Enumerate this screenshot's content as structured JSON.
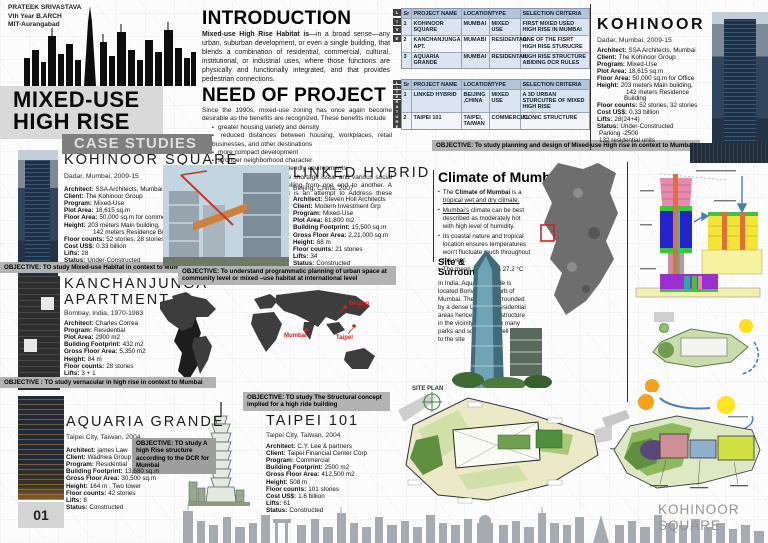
{
  "colors": {
    "accent_gray": "#b3b3b3",
    "header_gray": "#7f7f7f",
    "table_header_blue": "#b4c5da",
    "table_row_blue": "#dbe5f1",
    "map_marker_red": "#cc2222"
  },
  "header": {
    "author_line1": "PRATEEK SRIVASTAVA",
    "author_line2": "Vth Year B.ARCH",
    "author_line3": "MIT-Aurangabad",
    "title_line1": "MIXED-USE",
    "title_line2": "HIGH RISE",
    "case_studies": "CASE STUDIES"
  },
  "intro": {
    "heading": "INTRODUCTION",
    "lead_bold": "Mixed-use High Rise Habitat is",
    "lead_rest": "—in a broad sense—any urban, suburban development, or even a single building, that blends a combination of residential, commercial, cultural, institutional, or industrial uses, where those functions are physically and functionally integrated, and that provides pedestrian connections."
  },
  "need": {
    "heading": "NEED OF PROJECT",
    "para1": "Since the 1990s, mixed-use zoning has once again become desirable as the benefits are recognized. These benefits include",
    "bullets": [
      "greater housing variety and density",
      "reduced distances between housing, workplaces, retail businesses, and other destinations",
      "more compact development",
      "stronger neighborhood character",
      "pedestrian and bicycle-friendly environments"
    ],
    "para2": "Mumbai currently faces Space shortage issue and various social issues one of which is travelling from one end to another. A resilient mixed-used complex is an attempt to Address these issues."
  },
  "tables": {
    "headers": [
      "Sr",
      "PROJECT NAME",
      "LOCATION",
      "TYPE",
      "SELECTION CRITERIA"
    ],
    "live_label": [
      "L",
      "I",
      "V",
      "E"
    ],
    "literature_label": [
      "L",
      "I",
      "T",
      "E",
      "R",
      "A",
      "T",
      "U",
      "R",
      "E"
    ],
    "live_rows": [
      [
        "1",
        "KOHINOOR SQUARE",
        "MUMBAI",
        "MIXED USE",
        "FIRST MIXED USED HIGH RISE IN MUMBAI"
      ],
      [
        "2",
        "KANCHANJUNGA APT.",
        "MUMABI",
        "RESIDENTAIL",
        "ONE OF THE FISRT HIGH RISE STURUCRE"
      ],
      [
        "3",
        "AQUARIA GRANDE",
        "MUMBAI",
        "RESIDENTAIL",
        "HIGH RISE STRUCTURE ABIDING DCR RULES"
      ]
    ],
    "literature_rows": [
      [
        "1",
        "LINKED HYBRID",
        "BEIJING ,CHINA",
        "MIXED USE",
        "A 3D URBAN STURCUTRE OF MIXED HIGH RISE"
      ],
      [
        "2",
        "TAIPEI 101",
        "TAIPEI, TAIWAN",
        "COMMERCIAL",
        "ICONIC STRUCTURE"
      ]
    ],
    "objective": "OBJECTIVE: To study planning and design of Mixed-use High rise in context to Mumbai"
  },
  "kohinoor_left": {
    "title": "KOHINOOR SQUARE",
    "location": "Dadar, Mumbai, 2009-15",
    "details": [
      {
        "label": "Architect:",
        "value": "SSA Architects, Mumbai"
      },
      {
        "label": "Client:",
        "value": "The Kohinoor Group"
      },
      {
        "label": "Program:",
        "value": "Mixed-Use"
      },
      {
        "label": "Plot Area:",
        "value": "18,615 sq.m"
      },
      {
        "label": "Floor Area:",
        "value": "50,000 sq.m for commercial"
      },
      {
        "label": "Height:",
        "value": "203 meters Main building,"
      },
      {
        "label": "",
        "value": "142 meters Residence Building",
        "indent": "1"
      },
      {
        "label": "Floor counts:",
        "value": "52 stories, 28 stories"
      },
      {
        "label": "Cost US$:",
        "value": "0.33 billion"
      },
      {
        "label": "Lifts:",
        "value": "28"
      },
      {
        "label": "Status:",
        "value": "Under-Constructed"
      }
    ],
    "objective": "OBJECTIVE: TO study Mixed-use Habitat in context to Mumbai"
  },
  "kanchanjunga": {
    "title_line1": "KANCHANJUNGA",
    "title_line2": "APARTMENT",
    "location": "Bombay, India, 1970-1983",
    "details": [
      {
        "label": "Architect:",
        "value": "Charles Correa"
      },
      {
        "label": "Program:",
        "value": "Residential"
      },
      {
        "label": "Plot Area:",
        "value": "2900 m2"
      },
      {
        "label": "Building Footprint:",
        "value": "432 m2"
      },
      {
        "label": "Gross Floor Area:",
        "value": "5,350 m2"
      },
      {
        "label": "Height:",
        "value": "84 m"
      },
      {
        "label": "Floor counts:",
        "value": "28 stories"
      },
      {
        "label": "Lifts:",
        "value": "3 + 1"
      },
      {
        "label": "Status:",
        "value": "Constructed"
      }
    ],
    "objective": "OBJECTIVE : TO study vernacular in high rise in context to Mumbai"
  },
  "aquaria": {
    "title": "AQUARIA GRANDE",
    "location": "Taipei City, Taiwan, 2004",
    "objective": "OBJECTIVE: TO study A high Rise structure according to the DCR for Mumbai",
    "details": [
      {
        "label": "Architect:",
        "value": "james Law"
      },
      {
        "label": "Client:",
        "value": "Wadhwa Group"
      },
      {
        "label": "Program:",
        "value": "Residential"
      },
      {
        "label": "Building Footprint:",
        "value": "13,680 sq.m"
      },
      {
        "label": "Gross Floor Area:",
        "value": "30,500 sq.m"
      },
      {
        "label": "Height:",
        "value": "164 m , Two tower"
      },
      {
        "label": "Floor counts:",
        "value": "42 stories"
      },
      {
        "label": "Lifts:",
        "value": "8"
      },
      {
        "label": "Status:",
        "value": "Constructed"
      }
    ]
  },
  "linked_hybrid": {
    "title": "LINKED HYBRID",
    "location": "Beijing, China, 2007",
    "details": [
      {
        "label": "Architect:",
        "value": "Steven Holl Architects"
      },
      {
        "label": "Client:",
        "value": "Modern Investment Grp"
      },
      {
        "label": "Program:",
        "value": "Mixed-Use"
      },
      {
        "label": "Plot Area:",
        "value": "61,800 m2"
      },
      {
        "label": "Building Footprint:",
        "value": "15,500 sq.m"
      },
      {
        "label": "Gross Floor Area:",
        "value": "2,21,000 sq.m"
      },
      {
        "label": "Height:",
        "value": "68 m"
      },
      {
        "label": "Floor counts:",
        "value": "21 stories"
      },
      {
        "label": "Lifts:",
        "value": "34"
      },
      {
        "label": "Status:",
        "value": "Constructed"
      }
    ],
    "objective": "OBJECTIVE: To understand  programmatic planning of urban space at community level or mixed –use habitat at international level"
  },
  "taipei": {
    "objective": "OBJECTIVE: TO study The Structural concept implied for a high ride building",
    "title": "TAIPEI 101",
    "location": "Taipei City, Taiwan, 2004",
    "details": [
      {
        "label": "Architect:",
        "value": "C.Y. Lee & partners"
      },
      {
        "label": "Client:",
        "value": "Taipei Financial Center Corp"
      },
      {
        "label": "Program:",
        "value": "Commercial"
      },
      {
        "label": "Building Footprint:",
        "value": "2500 m2"
      },
      {
        "label": "Gross Floor Area:",
        "value": "412,500 m2"
      },
      {
        "label": "Height:",
        "value": "508 m"
      },
      {
        "label": "Floor counts:",
        "value": "101 stories"
      },
      {
        "label": "Cost US$:",
        "value": "1.6 billion"
      },
      {
        "label": "Lifts:",
        "value": "61"
      },
      {
        "label": "Status:",
        "value": "Constructed"
      }
    ]
  },
  "kohinoor_right": {
    "title": "KOHINOOR SQUARE",
    "location": "Dadar, Mumbai, 2009-15",
    "details": [
      {
        "label": "Architect:",
        "value": "SSA Architects, Mumbai"
      },
      {
        "label": "Client:",
        "value": "The Kohinoor Group"
      },
      {
        "label": "Program:",
        "value": "Mixed-Use"
      },
      {
        "label": "Plot Area:",
        "value": "18,615 sq.m"
      },
      {
        "label": "Floor Area:",
        "value": "50,000 sq.m for Office"
      },
      {
        "label": "Height:",
        "value": "203 meters Main building,"
      },
      {
        "label": "",
        "value": "142 meters Residence Building",
        "indent": "1"
      },
      {
        "label": "Floor counts:",
        "value": "52 stories, 32 stories"
      },
      {
        "label": "Cost US$:",
        "value": "0.33 billion"
      },
      {
        "label": "Lifts:",
        "value": "28(24+4)"
      },
      {
        "label": "Status:",
        "value": "Under-Constructed"
      },
      {
        "label": "",
        "value": "Parking -2500"
      },
      {
        "label": "",
        "value": "132 residential units"
      }
    ]
  },
  "climate": {
    "heading": "Climate of Mumbai",
    "b1_pre": "The ",
    "b1_bold": "Climate of Mumbai",
    "b1_mid": " is a ",
    "b1_link": "tropical wet and dry climate.",
    "b2_link": "Mumbai's",
    "b2_rest": " climate can be best described as moderately hot with high level of humidity.",
    "b3": "Its coastal nature and tropical location ensures temperatures won't fluctuate much throughout the year.",
    "b4": "The mean average is 27.2 °C",
    "site_heading_line1": "Site &",
    "site_heading_line2": "Surrounding",
    "site_body": "In India, Aquaria Grande is located Borivali, a suburb of Mumbai. The site is surrounded by a dense Low-Rise residential areas hence its Tallest structure in the vicinity. There are many parks and schools as well near to the site"
  },
  "map_labels": {
    "mumbai": "Mumbai",
    "beijing": "Beijing",
    "taipei": "Taipei"
  },
  "site_plan_label": "SITE PLAN",
  "footer": {
    "page_number": "01",
    "brand_line1": "KOHINOOR",
    "brand_line2": "SQUARE"
  }
}
